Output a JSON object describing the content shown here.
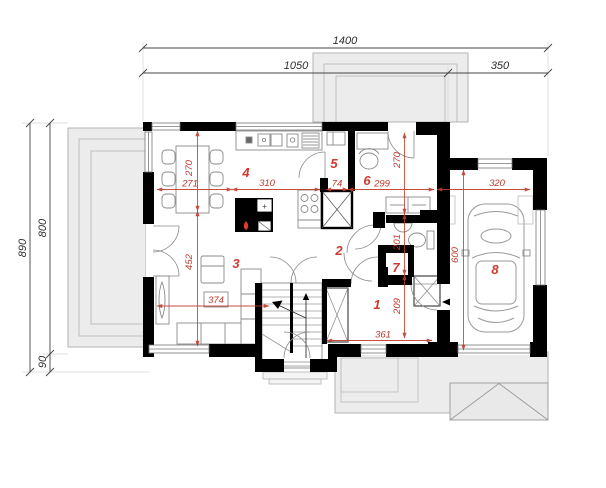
{
  "colors": {
    "wall": "#000000",
    "dimension_red": "#c0392b",
    "room_number_red": "#d03a30",
    "dimension_black": "#2e2e2e",
    "paving_gray": "#ececec",
    "outline_gray": "#9a9a9a"
  },
  "outer_dims": {
    "top_total": "1400",
    "top_left": "1050",
    "top_right": "350",
    "left_total": "890",
    "left_upper": "800",
    "left_lower": "90"
  },
  "red_dims": {
    "dining_width": "271",
    "dining_depth": "270",
    "kitchen_width": "310",
    "pantry_width": "74",
    "office_width": "299",
    "office_depth": "270",
    "garage_width": "320",
    "garage_depth": "600",
    "wc_depth": "201",
    "hall_depth": "209",
    "hall_width": "361",
    "living_width": "374",
    "living_depth": "452"
  },
  "rooms": {
    "r1": "1",
    "r2": "2",
    "r3": "3",
    "r4": "4",
    "r5": "5",
    "r6": "6",
    "r7": "7",
    "r8": "8"
  },
  "fireplace": {
    "plus": "+"
  }
}
